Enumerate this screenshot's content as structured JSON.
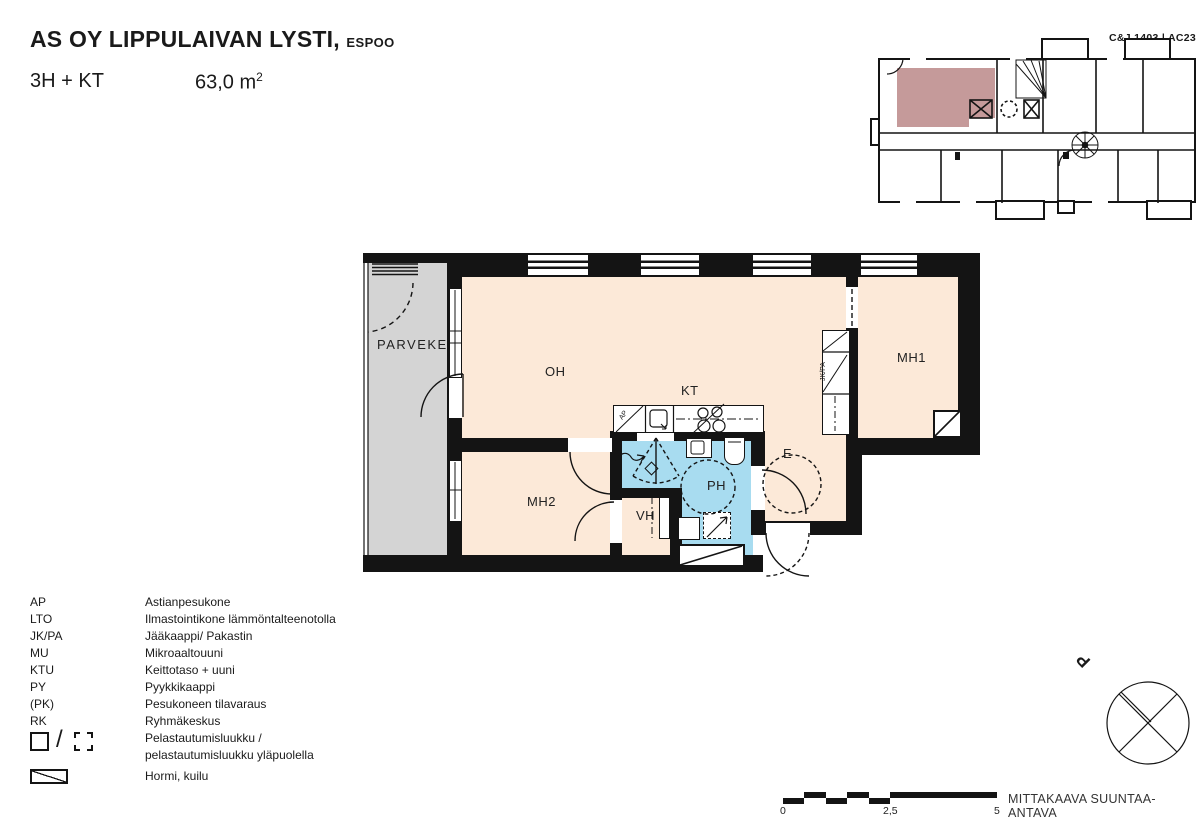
{
  "header": {
    "title": "AS OY LIPPULAIVAN LYSTI,",
    "location": "ESPOO",
    "unit_type": "3H + KT",
    "area_value": "63,0 m",
    "area_exponent": "2"
  },
  "overview": {
    "drawing_code": "C&J 1403",
    "separator": "|",
    "sheet_code": "AC23"
  },
  "floor_plan": {
    "rooms": {
      "parveke": "PARVEKE",
      "oh": "OH",
      "kt": "KT",
      "mh1": "MH1",
      "mh2": "MH2",
      "vh": "VH",
      "ph": "PH",
      "e": "E"
    },
    "fixtures": {
      "dishwasher": "AP",
      "fridge_freezer": "JK/PA"
    }
  },
  "legend": {
    "items": [
      {
        "abbr": "AP",
        "desc": "Astianpesukone"
      },
      {
        "abbr": "LTO",
        "desc": "Ilmastointikone lämmöntalteenotolla"
      },
      {
        "abbr": "JK/PA",
        "desc": "Jääkaappi/ Pakastin"
      },
      {
        "abbr": "MU",
        "desc": "Mikroaaltouuni"
      },
      {
        "abbr": "KTU",
        "desc": "Keittotaso + uuni"
      },
      {
        "abbr": "PY",
        "desc": "Pyykkikaappi"
      },
      {
        "abbr": "(PK)",
        "desc": "Pesukoneen tilavaraus"
      },
      {
        "abbr": "RK",
        "desc": "Ryhmäkeskus"
      }
    ],
    "hatch_slash": "/",
    "hatch_desc_line1": "Pelastautumisluukku /",
    "hatch_desc_line2": "pelastautumisluukku yläpuolella",
    "flue_desc": "Hormi, kuilu"
  },
  "scale_bar": {
    "tick_0": "0",
    "tick_mid": "2,5",
    "tick_end": "5",
    "note": "MITTAKAAVA SUUNTAA-ANTAVA"
  },
  "compass": {
    "north_label": "P"
  },
  "colors": {
    "room_fill": "#fce9d8",
    "bathroom_fill": "#a8dcf0",
    "balcony_fill": "#d4d4d4",
    "unit_highlight": "#c59a9a",
    "wall": "#141414"
  }
}
